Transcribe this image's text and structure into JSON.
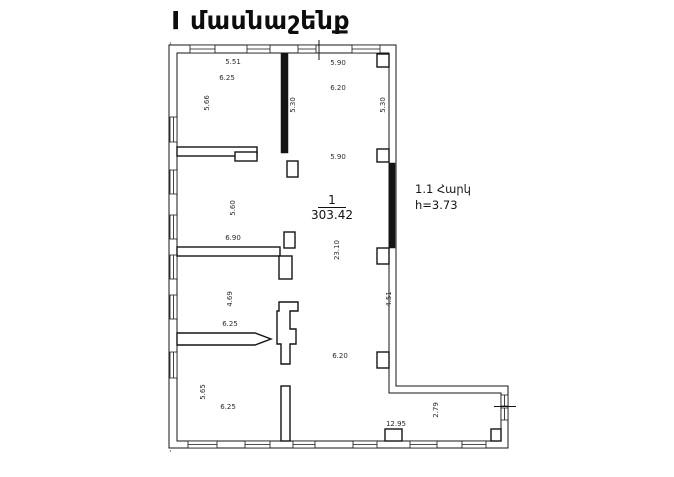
{
  "title": "Ι մասնաշենք",
  "floor_note": {
    "line1": "1.1 Հարկ",
    "line2": "h=3.73"
  },
  "room": {
    "number": "1",
    "area": "303.42"
  },
  "dims": [
    {
      "t": "5.51",
      "x": 233,
      "y": 62,
      "r": 0
    },
    {
      "t": "6.25",
      "x": 227,
      "y": 78,
      "r": 0
    },
    {
      "t": "5.66",
      "x": 207,
      "y": 103,
      "r": -90
    },
    {
      "t": "5.90",
      "x": 338,
      "y": 63,
      "r": 0
    },
    {
      "t": "6.20",
      "x": 338,
      "y": 88,
      "r": 0
    },
    {
      "t": "5.30",
      "x": 293,
      "y": 105,
      "r": -90
    },
    {
      "t": "5.30",
      "x": 383,
      "y": 105,
      "r": -90
    },
    {
      "t": "5.90",
      "x": 338,
      "y": 157,
      "r": 0
    },
    {
      "t": "5.60",
      "x": 233,
      "y": 208,
      "r": -90
    },
    {
      "t": "6.90",
      "x": 233,
      "y": 238,
      "r": 0
    },
    {
      "t": "23.10",
      "x": 337,
      "y": 250,
      "r": -90
    },
    {
      "t": "4.69",
      "x": 230,
      "y": 299,
      "r": -90
    },
    {
      "t": "6.25",
      "x": 230,
      "y": 324,
      "r": 0
    },
    {
      "t": "4.51",
      "x": 389,
      "y": 299,
      "r": -90
    },
    {
      "t": "6.20",
      "x": 340,
      "y": 356,
      "r": 0
    },
    {
      "t": "5.65",
      "x": 203,
      "y": 392,
      "r": -90
    },
    {
      "t": "6.25",
      "x": 228,
      "y": 407,
      "r": 0
    },
    {
      "t": "12.95",
      "x": 396,
      "y": 424,
      "r": 0
    },
    {
      "t": "2.79",
      "x": 436,
      "y": 410,
      "r": -90
    }
  ]
}
